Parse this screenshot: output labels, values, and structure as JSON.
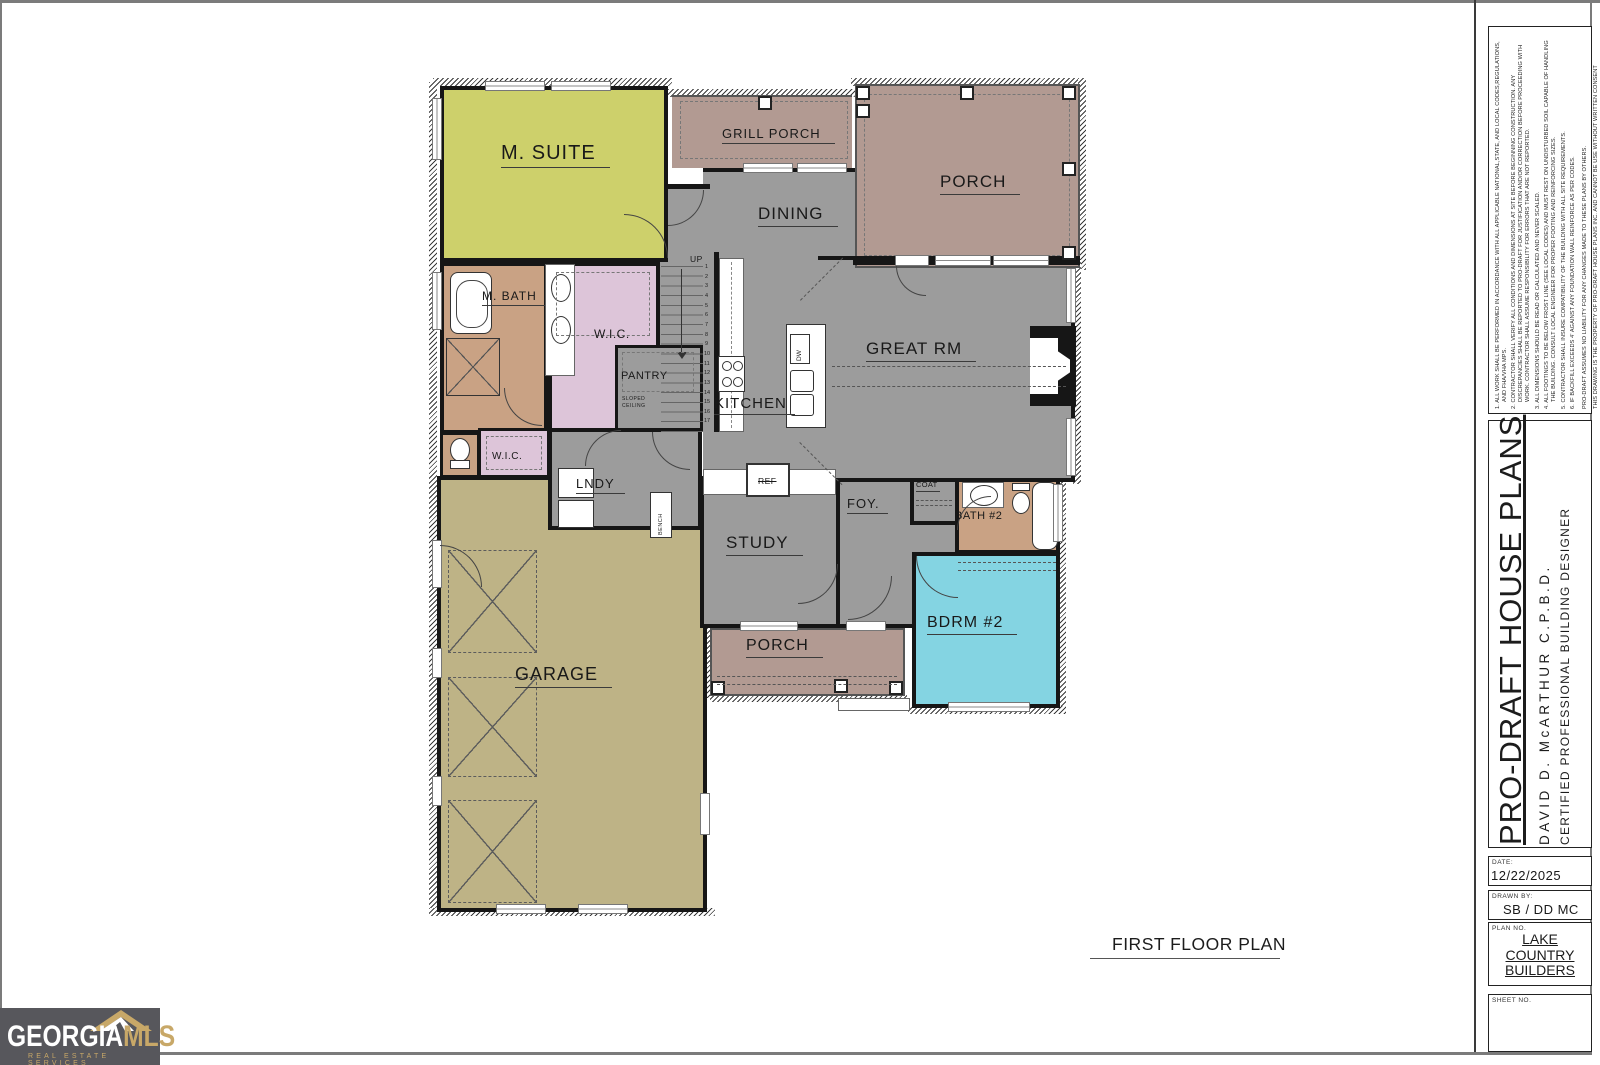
{
  "sheet": {
    "plan_label": "FIRST FLOOR PLAN"
  },
  "rooms": {
    "m_suite": "M. SUITE",
    "grill_porch": "GRILL PORCH",
    "porch_top": "PORCH",
    "dining": "DINING",
    "great_rm": "GREAT RM",
    "kitchen": "KITCHEN",
    "m_bath": "M. BATH",
    "wic1": "W.I.C.",
    "wic2": "W.I.C.",
    "pantry": "PANTRY",
    "sloped_1": "SLOPED",
    "sloped_2": "CEILING",
    "lndy": "LNDY",
    "bench": "BENCH",
    "study": "STUDY",
    "foy": "FOY.",
    "coat": "COAT",
    "ref": "REF",
    "dw": "DW",
    "bath2": "BATH #2",
    "bdrm2": "BDRM #2",
    "porch_bottom": "PORCH",
    "garage": "GARAGE"
  },
  "stairs": {
    "direction_label": "UP",
    "treads": [
      "1",
      "2",
      "3",
      "4",
      "5",
      "6",
      "7",
      "8",
      "9",
      "10",
      "11",
      "12",
      "13",
      "14",
      "15",
      "16",
      "17"
    ]
  },
  "titleblock": {
    "notes": [
      "1.  ALL WORK SHALL BE PERFORMED IN ACCORDANCE WITH ALL APPLICABLE NATIONAL,STATE, AND LOCAL CODES,REGULATIONS, AND FHA/VHA MPS.",
      "2.  CONTRACTOR SHALL VERIFY ALL CONDITIONS AND DIMENSIONS AT SITE BEFORE BEGINNING CONSTRUCTION. ANY DISCREPANCIES SHALL BE REPORTED TO PRO-DRAFT FOR JUSTIFICATION AND/OR CORRECTION BEFORE PROCEEDING WITH WORK. CONTRACTOR SHALL ASSUME RESPONSIBILITY FOR ERRORS THAT ARE NOT REPORTED.",
      "3.  ALL DIMENSIONS SHOULD BE READ OR CALCULATED AND NEVER SCALED.",
      "4.  ALL FOOTINGS TO BE BELOW FROST LINE (SEE LOCAL CODES) AND MUST REST ON UNDISTURBED SOIL CAPABLE OF HANDLING THE BUILDING. CONSULT LOCAL ENGINEER FOR PROPER FOOTING AND REINFORCING SIZES.",
      "5.  CONTRACTOR SHALL INSURE COMPATIBILITY OF THE BUILDING WITH ALL SITE REQUIREMENTS.",
      "6.  IF BACKFILL EXCEEDS 4' AGAINST ANY FOUNDATION WALL REINFORCE AS PER CODES."
    ],
    "liability": "PRO-DRAFT ASSUMES NO LIABILITY FOR ANY CHANGES MADE TO THESE PLANS BY OTHERS.",
    "copyright": "THIS DRAWING IS THE PROPERTY OF PRO-DRAFT HOUSE PLANS INC. AND CANNOT BE USE WITHOUT WRITTEN CONSENT",
    "company": "PRO-DRAFT HOUSE  PLANS",
    "designer": "DAVID D. McARTHUR C.P.B.D.",
    "credential": "CERTIFIED PROFESSIONAL BUILDING DESIGNER",
    "date_label": "DATE:",
    "date_value": "12/22/2025",
    "drawn_by_label": "DRAWN BY:",
    "drawn_by_value": "SB / DD MC",
    "plan_no_label": "PLAN NO.",
    "plan_no_line1": "LAKE",
    "plan_no_line2": "COUNTRY",
    "plan_no_line3": "BUILDERS",
    "sheet_no_label": "SHEET NO."
  },
  "logo": {
    "part1": "GEORGIA",
    "part2": "MLS",
    "tagline": "REAL ESTATE SERVICES"
  },
  "colors": {
    "wall": "#161616",
    "msuite": "#cdd06b",
    "garage": "#beb386",
    "bdrm2": "#84d4e2",
    "wic": "#ddc5d9",
    "bath": "#c9a284",
    "porch": "#b29a92",
    "gray": "#9c9c9c",
    "logo_bg": "#57575c",
    "logo_gold": "#c8a868"
  }
}
